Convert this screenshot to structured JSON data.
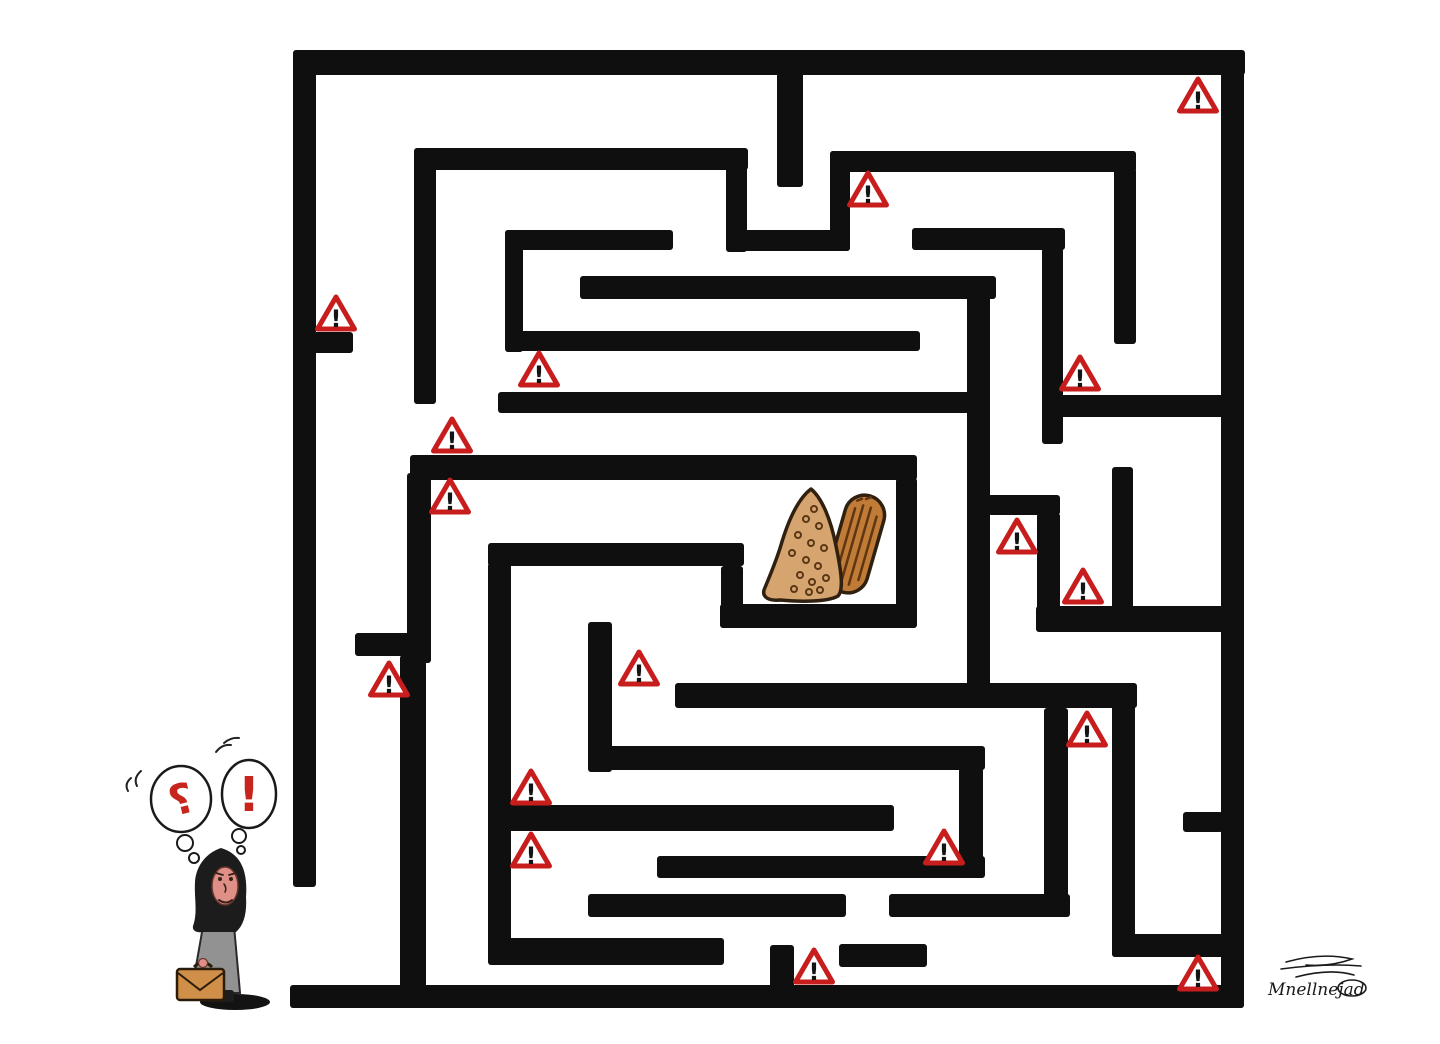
{
  "canvas": {
    "width": 1440,
    "height": 1044,
    "background": "#ffffff"
  },
  "maze": {
    "wall_color": "#0f0f0f",
    "walls": [
      {
        "x": 295,
        "y": 50,
        "w": 950,
        "h": 25
      },
      {
        "x": 293,
        "y": 50,
        "w": 23,
        "h": 837
      },
      {
        "x": 1221,
        "y": 50,
        "w": 23,
        "h": 958
      },
      {
        "x": 290,
        "y": 985,
        "w": 954,
        "h": 23
      },
      {
        "x": 777,
        "y": 70,
        "w": 26,
        "h": 117
      },
      {
        "x": 416,
        "y": 148,
        "w": 332,
        "h": 22
      },
      {
        "x": 726,
        "y": 166,
        "w": 21,
        "h": 86
      },
      {
        "x": 744,
        "y": 230,
        "w": 106,
        "h": 21
      },
      {
        "x": 830,
        "y": 151,
        "w": 20,
        "h": 100
      },
      {
        "x": 830,
        "y": 151,
        "w": 306,
        "h": 21
      },
      {
        "x": 1114,
        "y": 168,
        "w": 22,
        "h": 176
      },
      {
        "x": 414,
        "y": 148,
        "w": 22,
        "h": 256
      },
      {
        "x": 296,
        "y": 332,
        "w": 57,
        "h": 21
      },
      {
        "x": 505,
        "y": 230,
        "w": 168,
        "h": 20
      },
      {
        "x": 505,
        "y": 230,
        "w": 18,
        "h": 122
      },
      {
        "x": 510,
        "y": 331,
        "w": 410,
        "h": 20
      },
      {
        "x": 580,
        "y": 276,
        "w": 416,
        "h": 23
      },
      {
        "x": 967,
        "y": 291,
        "w": 23,
        "h": 399
      },
      {
        "x": 912,
        "y": 228,
        "w": 153,
        "h": 22
      },
      {
        "x": 1042,
        "y": 248,
        "w": 21,
        "h": 196
      },
      {
        "x": 1056,
        "y": 395,
        "w": 174,
        "h": 22
      },
      {
        "x": 498,
        "y": 392,
        "w": 475,
        "h": 21
      },
      {
        "x": 410,
        "y": 455,
        "w": 507,
        "h": 25
      },
      {
        "x": 896,
        "y": 478,
        "w": 21,
        "h": 150
      },
      {
        "x": 720,
        "y": 604,
        "w": 196,
        "h": 24
      },
      {
        "x": 721,
        "y": 566,
        "w": 22,
        "h": 62
      },
      {
        "x": 488,
        "y": 543,
        "w": 256,
        "h": 23
      },
      {
        "x": 488,
        "y": 563,
        "w": 23,
        "h": 390
      },
      {
        "x": 407,
        "y": 473,
        "w": 24,
        "h": 190
      },
      {
        "x": 355,
        "y": 633,
        "w": 66,
        "h": 23
      },
      {
        "x": 400,
        "y": 655,
        "w": 26,
        "h": 334
      },
      {
        "x": 988,
        "y": 495,
        "w": 72,
        "h": 20
      },
      {
        "x": 1037,
        "y": 513,
        "w": 23,
        "h": 118
      },
      {
        "x": 1112,
        "y": 467,
        "w": 21,
        "h": 144
      },
      {
        "x": 1036,
        "y": 606,
        "w": 198,
        "h": 26
      },
      {
        "x": 675,
        "y": 683,
        "w": 462,
        "h": 25
      },
      {
        "x": 1044,
        "y": 708,
        "w": 24,
        "h": 208
      },
      {
        "x": 889,
        "y": 894,
        "w": 181,
        "h": 23
      },
      {
        "x": 588,
        "y": 894,
        "w": 258,
        "h": 23
      },
      {
        "x": 588,
        "y": 622,
        "w": 24,
        "h": 150
      },
      {
        "x": 588,
        "y": 746,
        "w": 397,
        "h": 24
      },
      {
        "x": 959,
        "y": 768,
        "w": 24,
        "h": 110
      },
      {
        "x": 657,
        "y": 856,
        "w": 328,
        "h": 22
      },
      {
        "x": 508,
        "y": 805,
        "w": 386,
        "h": 26
      },
      {
        "x": 1112,
        "y": 690,
        "w": 23,
        "h": 267
      },
      {
        "x": 1112,
        "y": 934,
        "w": 120,
        "h": 23
      },
      {
        "x": 839,
        "y": 944,
        "w": 88,
        "h": 23
      },
      {
        "x": 488,
        "y": 938,
        "w": 236,
        "h": 27
      },
      {
        "x": 770,
        "y": 945,
        "w": 24,
        "h": 62
      },
      {
        "x": 1183,
        "y": 812,
        "w": 40,
        "h": 20
      }
    ]
  },
  "warning_signs": {
    "glyph": "!",
    "triangle_color": "#c81d1d",
    "glyph_color": "#141414",
    "fill_color": "#ffffff",
    "positions": [
      {
        "x": 336,
        "y": 315
      },
      {
        "x": 539,
        "y": 371
      },
      {
        "x": 868,
        "y": 191
      },
      {
        "x": 1198,
        "y": 97
      },
      {
        "x": 452,
        "y": 437
      },
      {
        "x": 450,
        "y": 498
      },
      {
        "x": 389,
        "y": 681
      },
      {
        "x": 1080,
        "y": 375
      },
      {
        "x": 1017,
        "y": 538
      },
      {
        "x": 1083,
        "y": 588
      },
      {
        "x": 639,
        "y": 670
      },
      {
        "x": 531,
        "y": 789
      },
      {
        "x": 531,
        "y": 852
      },
      {
        "x": 814,
        "y": 968
      },
      {
        "x": 944,
        "y": 849
      },
      {
        "x": 1087,
        "y": 731
      },
      {
        "x": 1198,
        "y": 975
      }
    ]
  },
  "bread": {
    "left_loaf_color": "#d6a46e",
    "right_loaf_color": "#c07b36",
    "outline_color": "#2f2010",
    "speckle_color": "#5a3716",
    "ridge_color": "#5f3512"
  },
  "character": {
    "question_bubble_glyph": "؟",
    "exclaim_bubble_glyph": "!",
    "bubble_glyph_color": "#c9251f",
    "bubble_outline_color": "#1a1a1a",
    "scarf_color": "#1c1c1c",
    "face_color": "#df9086",
    "dress_color": "#929292",
    "briefcase_color": "#cf8f49",
    "shadow_color": "#131313"
  },
  "signature": {
    "reading": "Mnellnejad",
    "color": "#1a1a1a"
  }
}
